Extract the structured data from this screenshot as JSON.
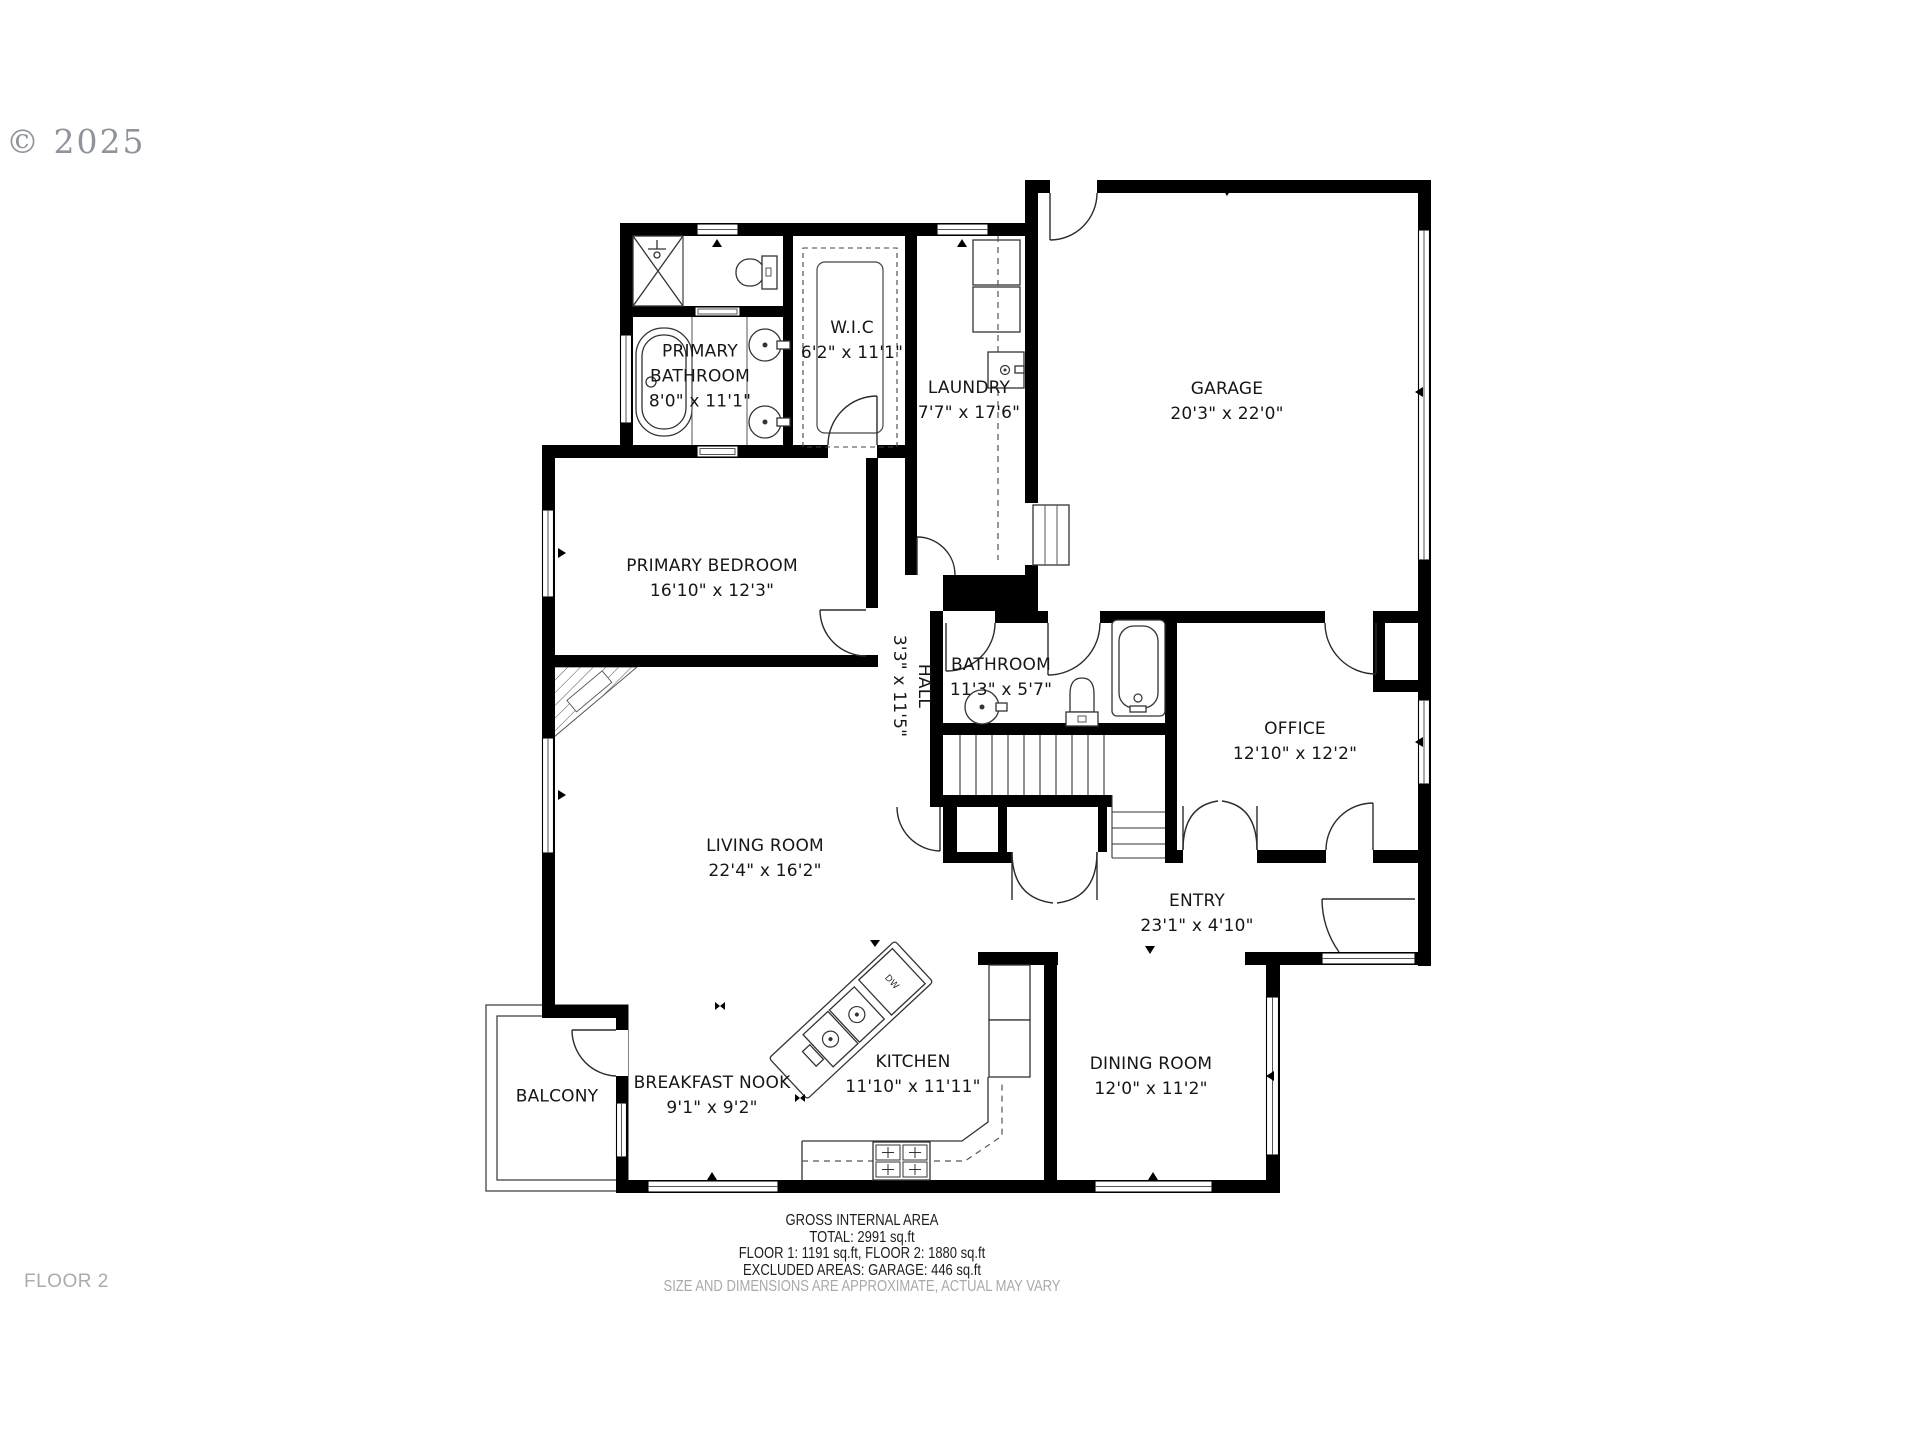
{
  "copyright": "© 2025",
  "floor_label": "FLOOR 2",
  "rooms": [
    {
      "name": "PRIMARY BATHROOM",
      "dims": "8'0\" x 11'1\""
    },
    {
      "name": "W.I.C",
      "dims": "6'2\" x 11'1\""
    },
    {
      "name": "LAUNDRY",
      "dims": "7'7\" x 17'6\""
    },
    {
      "name": "GARAGE",
      "dims": "20'3\" x 22'0\""
    },
    {
      "name": "PRIMARY BEDROOM",
      "dims": "16'10\" x 12'3\""
    },
    {
      "name": "HALL",
      "dims": "3'3\" x 11'5\""
    },
    {
      "name": "BATHROOM",
      "dims": "11'3\" x 5'7\""
    },
    {
      "name": "OFFICE",
      "dims": "12'10\" x 12'2\""
    },
    {
      "name": "LIVING ROOM",
      "dims": "22'4\" x 16'2\""
    },
    {
      "name": "ENTRY",
      "dims": "23'1\" x 4'10\""
    },
    {
      "name": "BALCONY",
      "dims": ""
    },
    {
      "name": "BREAKFAST NOOK",
      "dims": "9'1\" x 9'2\""
    },
    {
      "name": "KITCHEN",
      "dims": "11'10\" x 11'11\""
    },
    {
      "name": "DINING ROOM",
      "dims": "12'0\" x 11'2\""
    }
  ],
  "labels": {
    "dw": "DW"
  },
  "footer": {
    "line1": "GROSS INTERNAL AREA",
    "line2": "TOTAL: 2991 sq.ft",
    "line3": "FLOOR 1: 1191 sq.ft, FLOOR 2: 1880 sq.ft",
    "line4": "EXCLUDED AREAS: GARAGE: 446 sq.ft",
    "disclaimer": "SIZE AND DIMENSIONS ARE APPROXIMATE, ACTUAL MAY VARY"
  },
  "colors": {
    "walls": "#000000",
    "muted_text": "#a9a9a9",
    "label_text": "#161616"
  }
}
